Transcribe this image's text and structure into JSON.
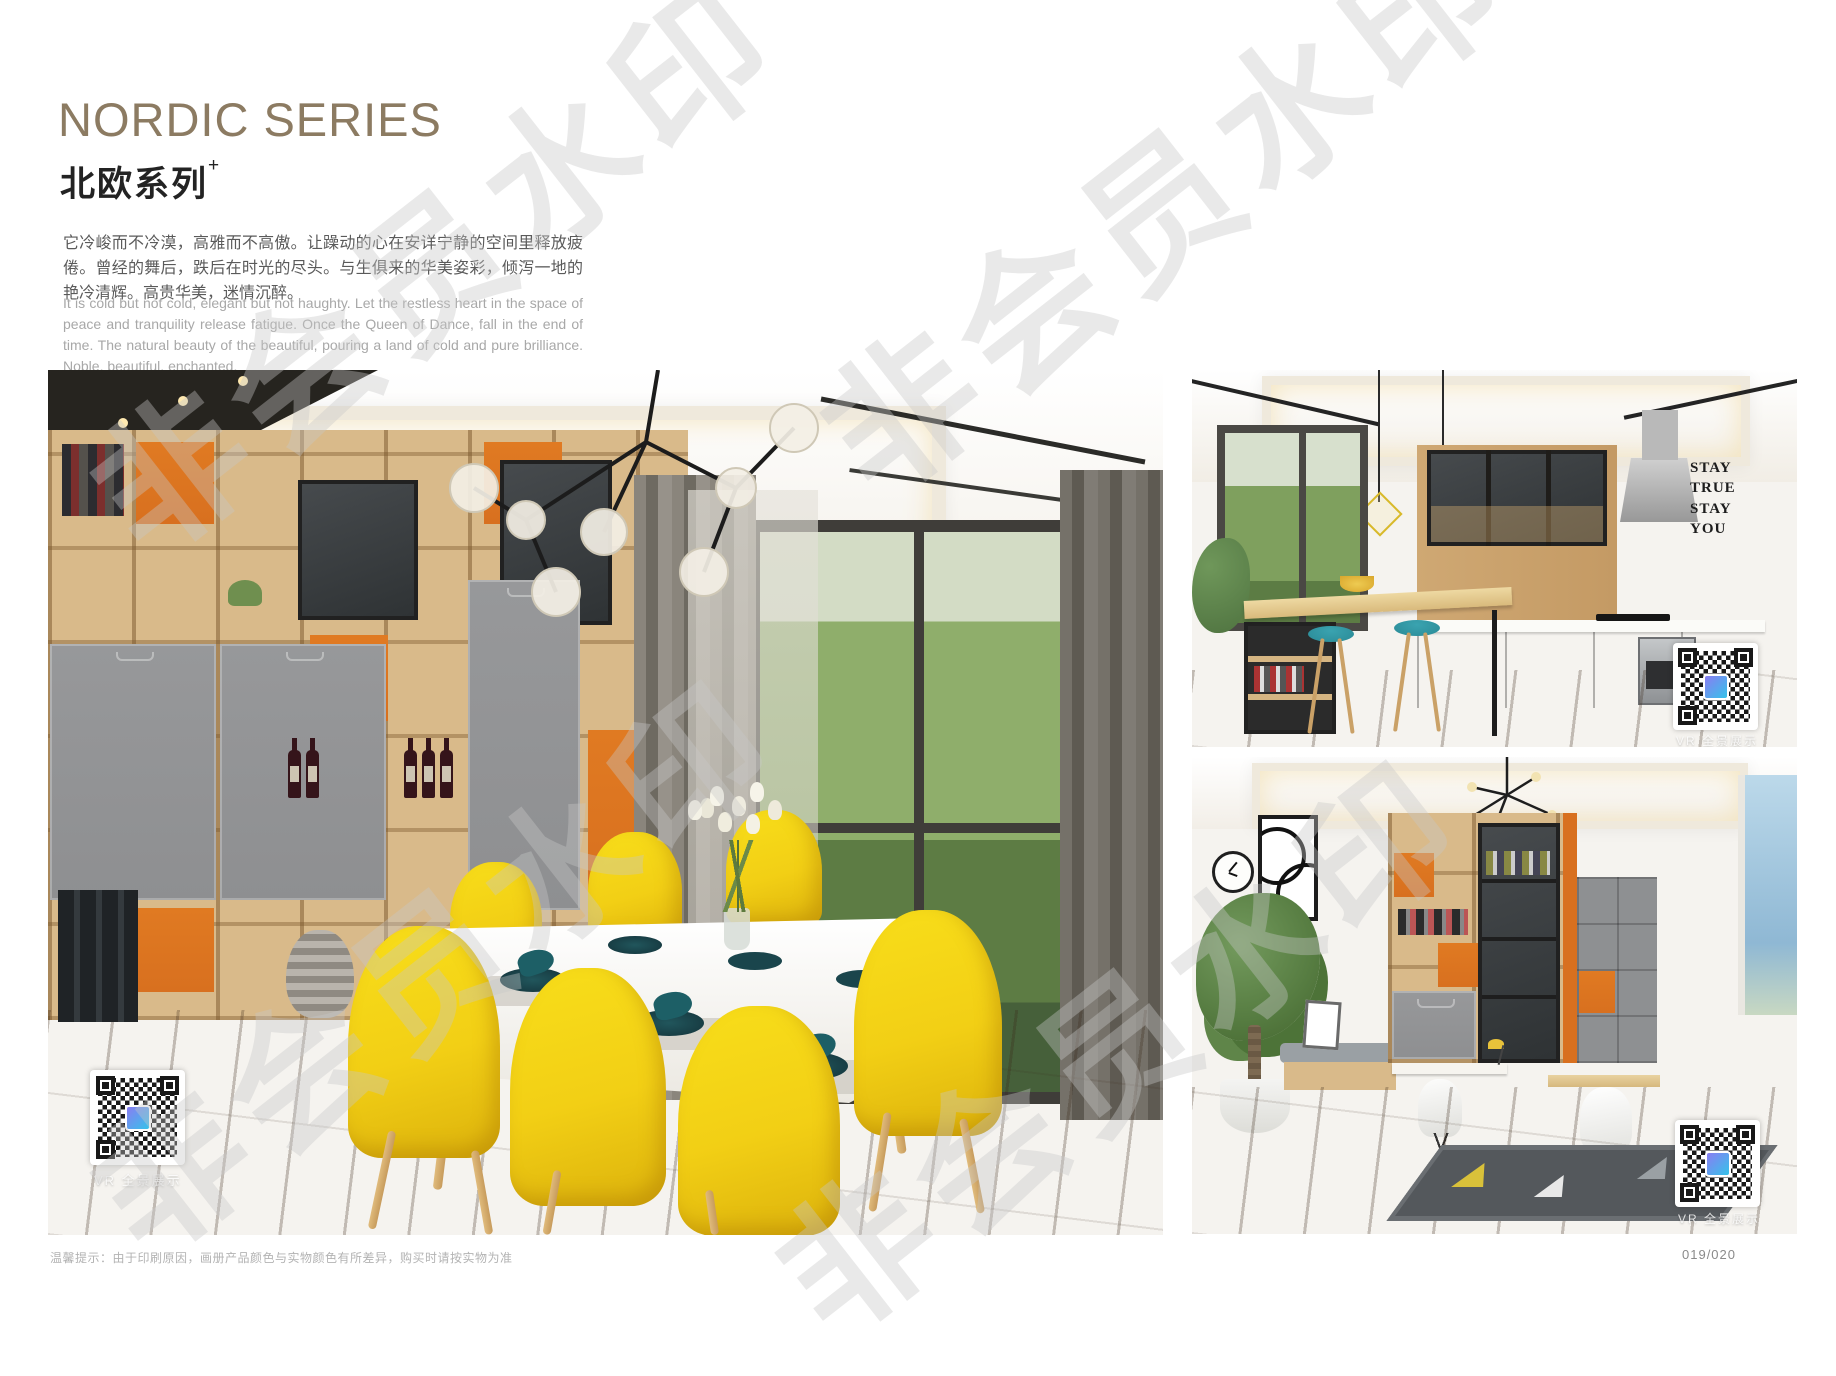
{
  "page": {
    "title": "NORDIC SERIES",
    "subtitle": "北欧系列",
    "subtitle_sup": "+",
    "intro_zh": "它冷峻而不冷漠，高雅而不高傲。让躁动的心在安详宁静的空间里释放疲倦。曾经的舞后，跌后在时光的尽头。与生俱来的华美姿彩，倾泻一地的艳冷清辉。高贵华美，迷情沉醉。",
    "intro_en": "It is cold but not cold, elegant but not haughty. Let the restless heart in the space of peace and tranquility release fatigue. Once the Queen of Dance, fall in the end of time. The natural beauty of the beautiful, pouring a land of cold and pure brilliance. Noble, beautiful, enchanted.",
    "footnote": "温馨提示：由于印刷原因，画册产品颜色与实物颜色有所差异，购买时请按实物为准",
    "page_number": "019/020"
  },
  "watermark": {
    "text": "非会员水印"
  },
  "photos": {
    "dining": {
      "qr_label": "VR 全景展示"
    },
    "kitchen": {
      "qr_label": "VR 全景展示",
      "wall_art": [
        "STAY",
        "TRUE",
        "STAY",
        "YOU"
      ]
    },
    "study": {
      "qr_label": "VR 全景展示"
    }
  },
  "colors": {
    "title_bronze": "#8c7b62",
    "body_text": "#5a5a5a",
    "en_text": "#a8a8a8",
    "accent_orange": "#d8701f",
    "chair_yellow": "#f2cf15",
    "teal": "#2a8a96",
    "wood_light": "#d9ba8a",
    "cabinet_gray": "#8e8f91",
    "watermark_gray": "#c8c8c8"
  }
}
